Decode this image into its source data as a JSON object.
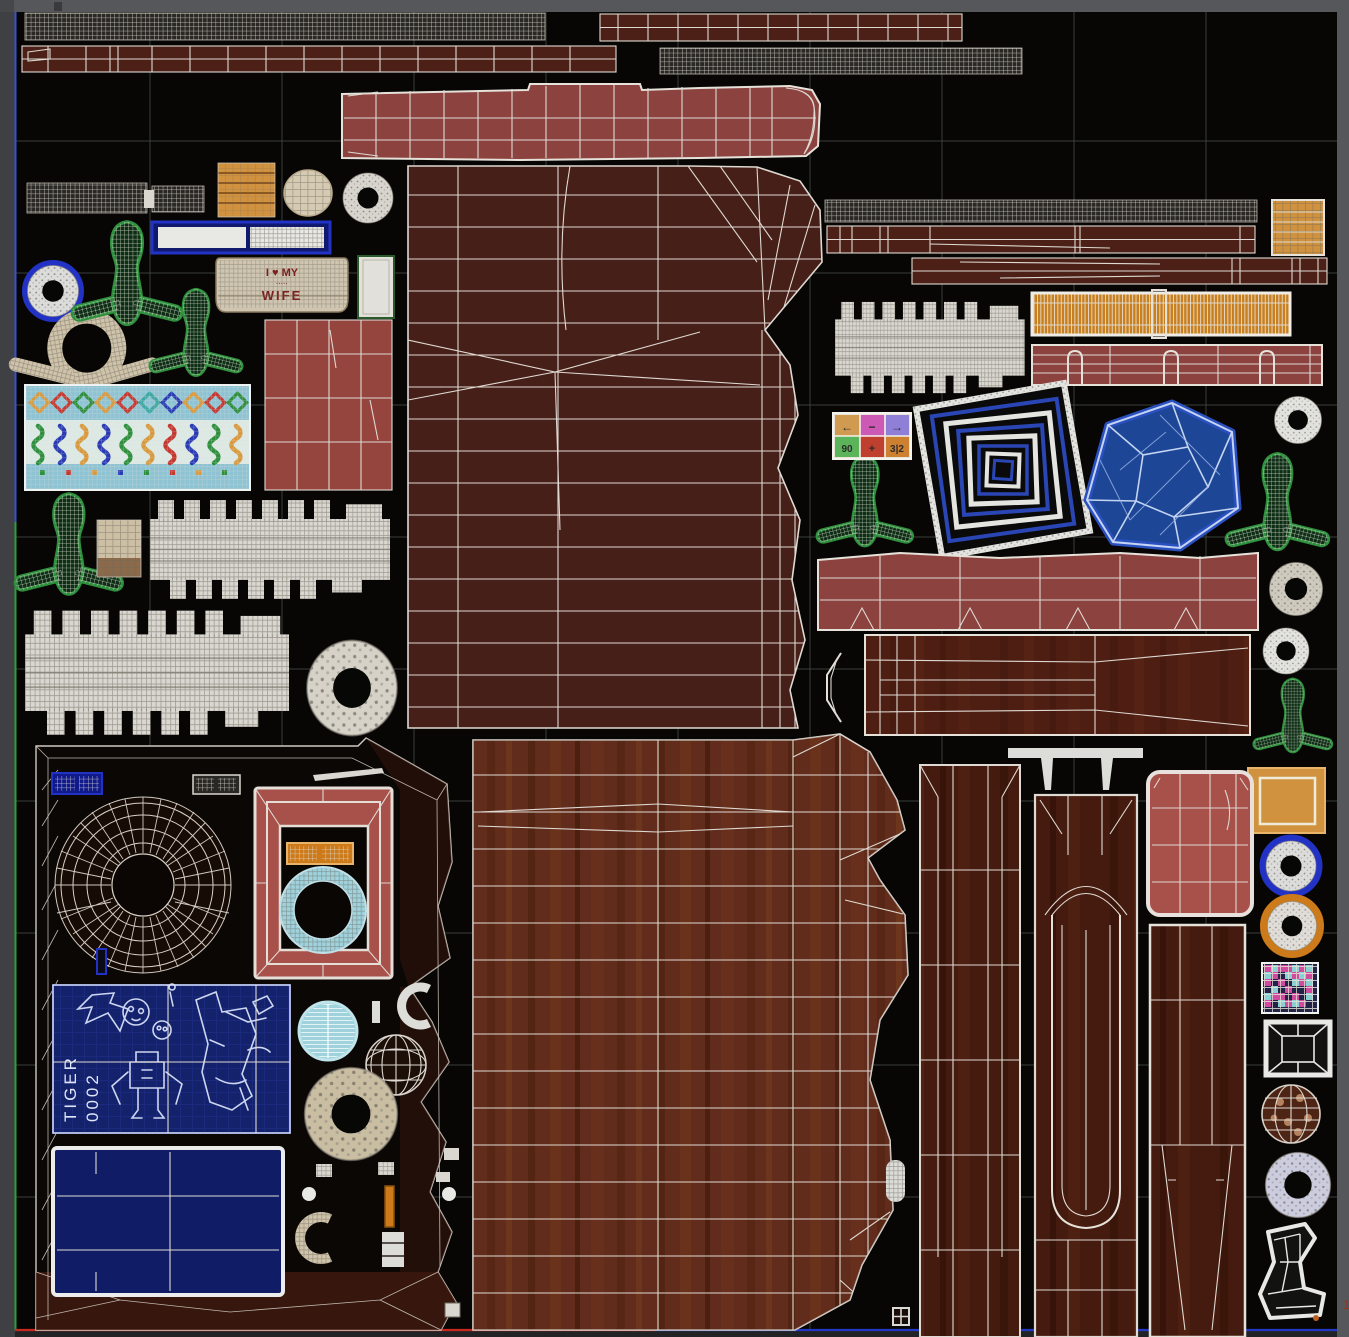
{
  "app": {
    "title": "uv-texture-editor-canvas",
    "right_ruler_label": "1"
  },
  "colors": {
    "frameTop": "#55575b",
    "frameLeft": "#3e4043",
    "frameRight": "#55575b",
    "canvas": "#070604",
    "gridline": "#3d4341",
    "axisBlue": "#3a50d0",
    "axisGreen": "#2e9e38",
    "axisRed": "#c82820",
    "maroonDark": "#461f18",
    "maroonStrip": "#4c2016",
    "brickRed": "#8c4340",
    "redBlock": "#96443e",
    "redFrame": "#a8504a",
    "woodMid": "#6b3120",
    "woodDark": "#451b0f",
    "plank": "#552014",
    "orangeWood": "#d0923f",
    "amber": "#c87f1f",
    "orangeBadge": "#cc7a1a",
    "beige": "#d5cab2",
    "whiteMesh": "#d9d7d0",
    "blueRing": "#2232c4",
    "navyBlueprint": "#14226b",
    "navyPlain": "#101d66",
    "skyPattern": "#8ec3d3",
    "gemBlue": "#1d4796",
    "cyanRing": "#9fd2dc",
    "pickleGreen": "#2e8f3c",
    "pickleFill": "#0d2e14",
    "checkerPink": "#d04a9e",
    "checkerCyan": "#8ad2d2"
  },
  "texts": {
    "mug_line1": "I ♥ MY",
    "mug_line2": "·····",
    "mug_line3": "WIFE",
    "blueprint_word1": "TIGER",
    "blueprint_word2": "0002"
  },
  "arrowpad": {
    "cells": [
      {
        "glyph": "←",
        "color": "#d09a50"
      },
      {
        "glyph": "−",
        "color": "#cc5ab4"
      },
      {
        "glyph": "→",
        "color": "#8f7fd6"
      },
      {
        "glyph": "90",
        "color": "#5cb45a"
      },
      {
        "glyph": "+",
        "color": "#c04030"
      },
      {
        "glyph": "3|2",
        "color": "#cc8030"
      }
    ]
  },
  "islands": [
    "mesh-strip-top-left",
    "trim-strip-top-right",
    "trim-strip-row2",
    "mesh-strip-row2",
    "red-bench-bar",
    "mesh-strip-right",
    "trim-strip-right-a",
    "orange-block-right",
    "trim-strip-right-b",
    "amber-grille-strip",
    "zipper-comb-right",
    "red-loop-strip",
    "mesh-strip-small",
    "wood-block-small",
    "beige-knob",
    "white-torus-small",
    "blue-label-strip",
    "pickle-a",
    "mug-wrap-label",
    "white-card",
    "blue-ring",
    "pickle-b",
    "beige-rope-loop",
    "ornament-pattern-block",
    "red-grid-block",
    "pickle-c",
    "tan-block",
    "zipper-comb-a",
    "zipper-comb-b",
    "white-torus-big",
    "maroon-body-panel",
    "arrow-pad-widget",
    "pickle-d",
    "square-spiral-target",
    "blue-gem",
    "speckle-ring-a",
    "pickle-e",
    "red-fold-strip",
    "white-torus-c",
    "wood-plank",
    "chevron-bracket",
    "white-ring-d",
    "pickle-f",
    "orange-panel-right",
    "left-bottom-panel-outline",
    "blue-grid-badge",
    "white-grid-badge",
    "radial-disk",
    "red-picture-frame",
    "orange-grid-badge",
    "cyan-ring-thick",
    "blueprint-sketch",
    "blueprint-plain",
    "cyan-lined-disc",
    "wire-sphere",
    "beige-torus",
    "pickle-g",
    "beige-c-bracket",
    "orange-stick",
    "white-ibeam",
    "wood-body-panel",
    "white-capsule-small",
    "wood-column-a",
    "white-t-bracket",
    "wood-column-b",
    "red-rounded-panel",
    "wood-column-c",
    "blue-rim-ring",
    "orange-rim-ring",
    "pink-checker-swatch",
    "wire-box",
    "choco-ball",
    "lavender-torus",
    "wire-boot",
    "grid-icon-small"
  ]
}
